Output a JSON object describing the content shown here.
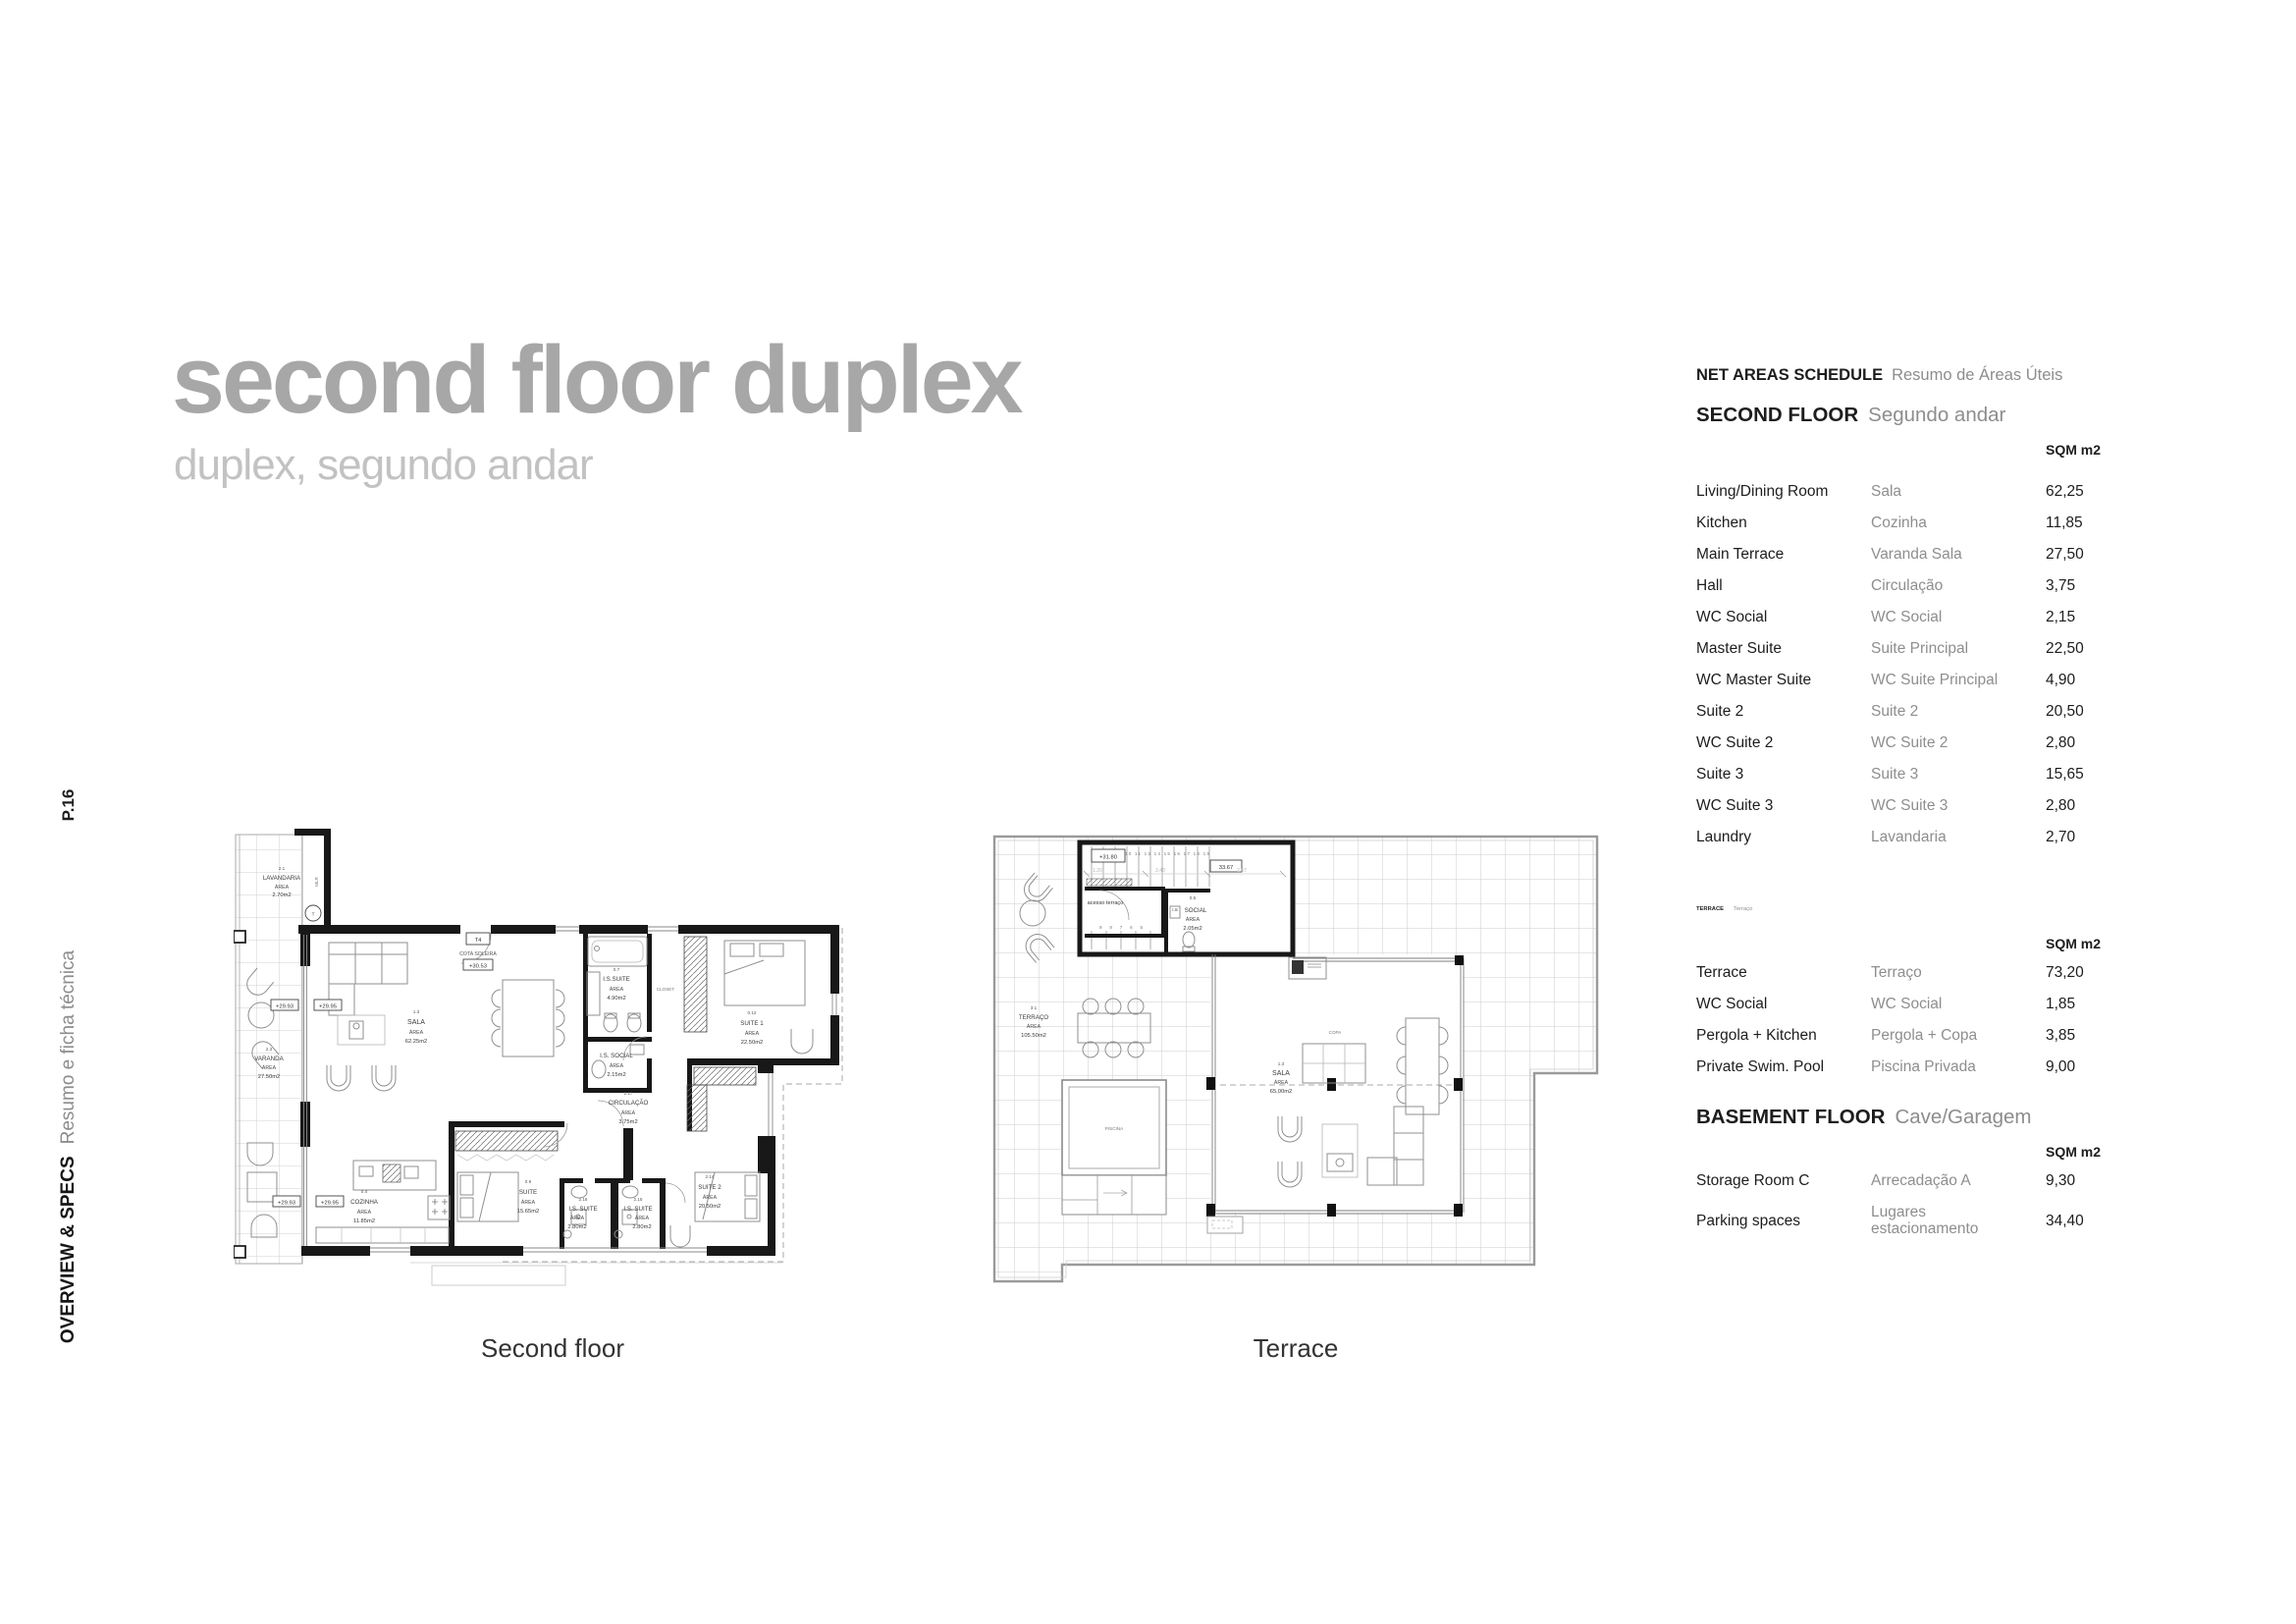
{
  "page": {
    "number": "P.16",
    "section_en": "OVERVIEW & SPECS",
    "section_pt": "Resumo e ficha técnica",
    "title": "second floor duplex",
    "subtitle": "duplex, segundo andar"
  },
  "schedule": {
    "title_en": "NET AREAS SCHEDULE",
    "title_pt": "Resumo de Áreas Úteis",
    "unit": "SQM m2",
    "sections": [
      {
        "name_en": "SECOND FLOOR",
        "name_pt": "Segundo andar",
        "rows": [
          {
            "en": "Living/Dining Room",
            "pt": "Sala",
            "sqm": "62,25"
          },
          {
            "en": "Kitchen",
            "pt": "Cozinha",
            "sqm": "11,85"
          },
          {
            "en": "Main Terrace",
            "pt": "Varanda Sala",
            "sqm": "27,50"
          },
          {
            "en": "Hall",
            "pt": "Circulação",
            "sqm": "3,75"
          },
          {
            "en": "WC Social",
            "pt": "WC Social",
            "sqm": "2,15"
          },
          {
            "en": "Master Suite",
            "pt": "Suite Principal",
            "sqm": "22,50"
          },
          {
            "en": "WC Master Suite",
            "pt": "WC Suite Principal",
            "sqm": "4,90"
          },
          {
            "en": "Suite 2",
            "pt": "Suite 2",
            "sqm": "20,50"
          },
          {
            "en": "WC Suite 2",
            "pt": "WC Suite 2",
            "sqm": "2,80"
          },
          {
            "en": "Suite 3",
            "pt": "Suite 3",
            "sqm": "15,65"
          },
          {
            "en": "WC Suite 3",
            "pt": "WC Suite 3",
            "sqm": "2,80"
          },
          {
            "en": "Laundry",
            "pt": "Lavandaria",
            "sqm": "2,70"
          }
        ]
      },
      {
        "name_en": "TERRACE",
        "name_pt": "Terraço",
        "rows": [
          {
            "en": "Terrace",
            "pt": "Terraço",
            "sqm": "73,20"
          },
          {
            "en": "WC Social",
            "pt": "WC Social",
            "sqm": "1,85"
          },
          {
            "en": "Pergola + Kitchen",
            "pt": "Pergola + Copa",
            "sqm": "3,85"
          },
          {
            "en": "Private Swim. Pool",
            "pt": "Piscina Privada",
            "sqm": "9,00"
          }
        ]
      },
      {
        "name_en": "BASEMENT FLOOR",
        "name_pt": "Cave/Garagem",
        "rows": [
          {
            "en": "Storage Room C",
            "pt": "Arrecadação A",
            "sqm": "9,30"
          },
          {
            "en": "Parking spaces",
            "pt": "Lugares estacionamento",
            "sqm": "34,40"
          }
        ]
      }
    ]
  },
  "plan1": {
    "caption": "Second floor",
    "area_word": "ÁREA",
    "rooms": {
      "lavandaria": {
        "no": "2.1",
        "name": "LAVANDARIA",
        "sqm": "2.70m2"
      },
      "varanda": {
        "no": "2.3",
        "name": "VARANDA",
        "sqm": "27.50m2"
      },
      "sala": {
        "no": "1.3",
        "name": "SALA",
        "sqm": "62.25m2"
      },
      "is_suite": {
        "no": "0.7",
        "name": "I.S.SUITE",
        "sqm": "4.90m2"
      },
      "closet": {
        "name": "CLOSET"
      },
      "suite1": {
        "no": "0.12",
        "name": "SUITE 1",
        "sqm": "22.50m2"
      },
      "is_social": {
        "name": "I.S. SOCIAL",
        "sqm": "2.15m2"
      },
      "circulacao": {
        "no": "2.17",
        "name": "CIRCULAÇÃO",
        "sqm": "3.75m2"
      },
      "cozinha": {
        "no": "0.4",
        "name": "COZINHA",
        "sqm": "11.85m2"
      },
      "suite": {
        "no": "0.9",
        "name": "SUITE",
        "sqm": "15.65m2"
      },
      "is_suite_l": {
        "no": "2.16",
        "name": "I.S. SUITE",
        "sqm": "2.80m2"
      },
      "is_suite_r": {
        "no": "2.15",
        "name": "I.S. SUITE",
        "sqm": "2.80m2"
      },
      "suite2": {
        "no": "2.14",
        "name": "SUITE 2",
        "sqm": "20.50m2"
      }
    },
    "markers": {
      "t4": "T4",
      "cota_label": "COTA SOLEIRA",
      "cota_value": "+30.53",
      "level_a": "+29.93",
      "level_b": "+29.95",
      "machine": "MLR",
      "t": "T"
    }
  },
  "plan2": {
    "caption": "Terrace",
    "area_word": "ÁREA",
    "rooms": {
      "terraco": {
        "no": "3.1",
        "name": "TERRAÇO",
        "sqm": "105.50m2"
      },
      "sala": {
        "no": "1.3",
        "name": "SALA",
        "sqm": "65,00m2"
      },
      "is_social": {
        "no": "0.5",
        "name_a": "I.S",
        "name_b": "SOCIAL",
        "sqm": "2.05m2"
      },
      "copa": {
        "name": "COPA"
      },
      "piscina": {
        "name": "PISCINA"
      },
      "acesso": {
        "name": "acesso terraço"
      }
    },
    "markers": {
      "level": "+31.80",
      "cota": "33.67",
      "dim1": "1.20",
      "dim2": "2.40",
      "dim3": "2.67",
      "steps_top": "10 11 13 14 15 16 17 18 19",
      "steps_bottom": "9 8 7 6 5"
    }
  }
}
